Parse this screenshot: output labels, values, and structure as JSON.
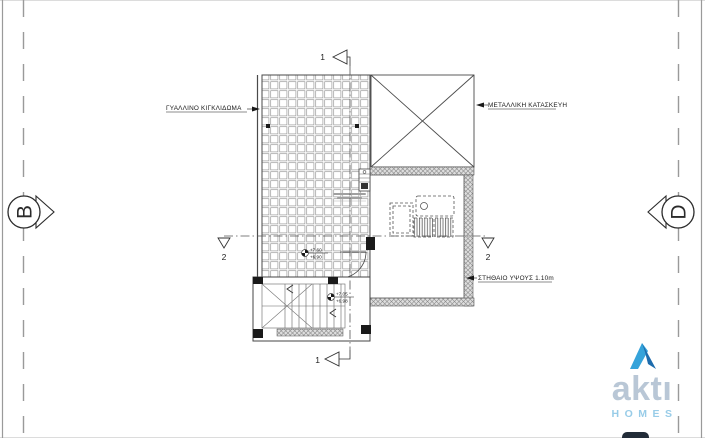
{
  "sheet": {
    "labels": {
      "glass_railing": "ΓΥΑΛΛΙΝΟ ΚΙΓΚΛΙΔΩΜΑ",
      "metal_construction": "ΜΕΤΑΛΛΙΚΗ ΚΑΤΑΣΚΕΥΗ",
      "parapet": "ΣΤΗΘΑΙΟ ΥΨΟΥΣ 1.10m"
    },
    "section_markers": {
      "left": "B",
      "right": "D"
    },
    "section_cuts": {
      "vertical": "1",
      "horizontal": "2"
    },
    "levels": {
      "terrace": {
        "top": "+7.60",
        "bottom": "+6.90"
      },
      "landing": {
        "top": "+7.05",
        "bottom": "+6.98"
      }
    }
  },
  "logo": {
    "name": "aktı",
    "tagline": "HOMES",
    "colors": {
      "mark_light": "#35a3da",
      "mark_dark": "#1d6cad",
      "name": "#b9c7d6",
      "tagline": "#98cce8"
    }
  }
}
